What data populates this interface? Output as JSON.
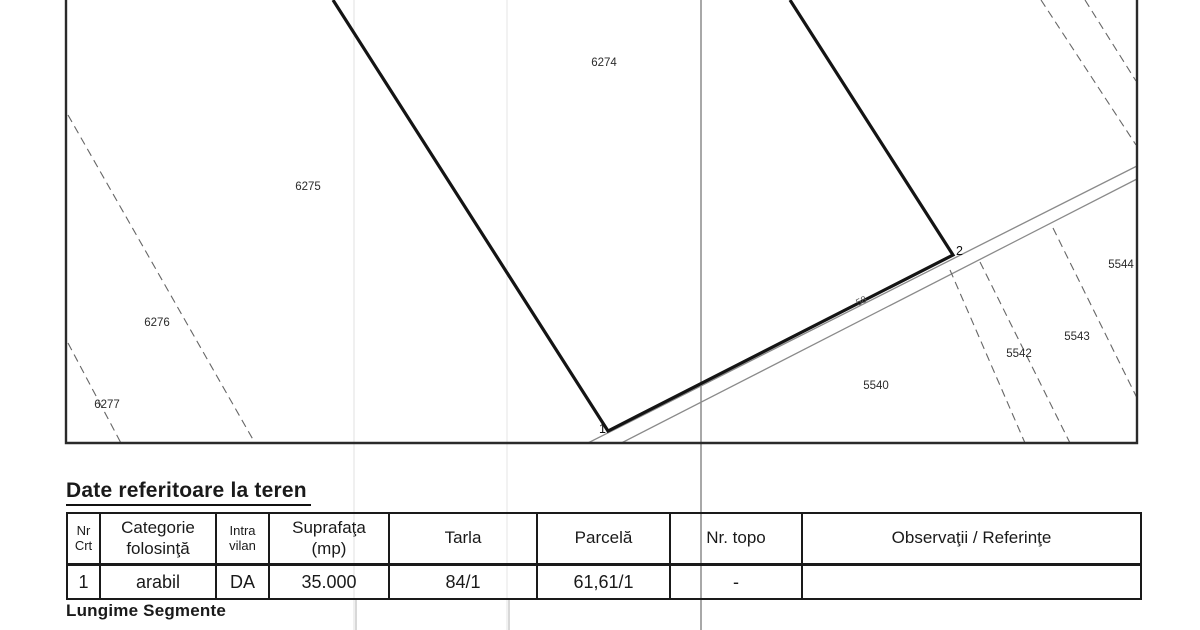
{
  "map": {
    "parcels": {
      "p6274": "6274",
      "p6275": "6275",
      "p6276": "6276",
      "p6277": "6277",
      "p5540": "5540",
      "p5542": "5542",
      "p5543": "5543",
      "p5544": "5544"
    },
    "vertices": {
      "v1": "1",
      "v2": "2"
    },
    "segment_length": "58",
    "line_color": "#1a1a1a",
    "light_line_color": "#8a8a8a"
  },
  "teren_table": {
    "title": "Date referitoare la teren",
    "headers": [
      {
        "lines": [
          "Nr",
          "Crt"
        ]
      },
      {
        "lines": [
          "Categorie",
          "folosinţă"
        ]
      },
      {
        "lines": [
          "Intra",
          "vilan"
        ]
      },
      {
        "lines": [
          "Suprafaţa",
          "(mp)"
        ]
      },
      {
        "lines": [
          "Tarla"
        ]
      },
      {
        "lines": [
          "Parcelă"
        ]
      },
      {
        "lines": [
          "Nr. topo"
        ]
      },
      {
        "lines": [
          "Observaţii / Referinţe"
        ]
      }
    ],
    "row": {
      "nr_crt": "1",
      "categorie": "arabil",
      "intravilan": "DA",
      "suprafata": "35.000",
      "tarla": "84/1",
      "parcela": "61,61/1",
      "nr_topo": "-",
      "observatii": ""
    }
  },
  "segments_heading": "Lungime Segmente"
}
